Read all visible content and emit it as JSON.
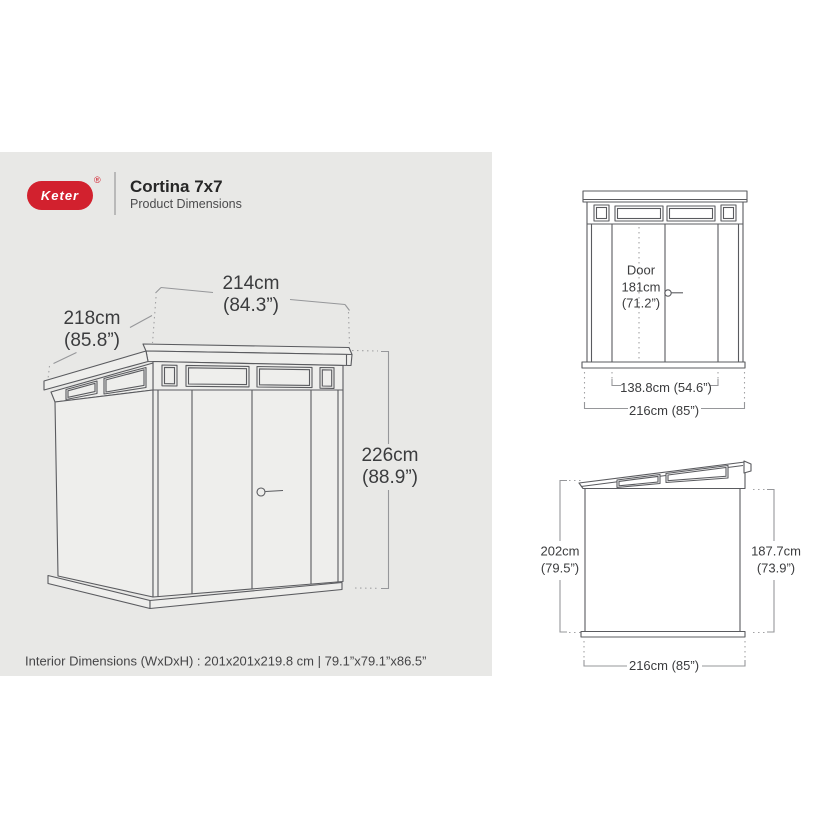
{
  "header": {
    "logo_text": "Keter",
    "registered_mark": "®",
    "title": "Cortina 7x7",
    "subtitle": "Product Dimensions"
  },
  "colors": {
    "brand_red": "#d2212e",
    "panel_gray": "#e8e8e6",
    "line_gray": "#5a5b5f"
  },
  "iso_view": {
    "width_dim": {
      "cm": "214cm",
      "inch": "(84.3”)"
    },
    "depth_dim": {
      "cm": "218cm",
      "inch": "(85.8”)"
    },
    "height_dim": {
      "cm": "226cm",
      "inch": "(88.9”)"
    }
  },
  "front_view": {
    "door_label": {
      "line1": "Door",
      "line2": "181cm",
      "line3": "(71.2”)"
    },
    "door_width": "138.8cm (54.6”)",
    "overall_width": "216cm (85”)"
  },
  "side_view": {
    "left_height": {
      "cm": "202cm",
      "inch": "(79.5”)"
    },
    "right_height": {
      "cm": "187.7cm",
      "inch": "(73.9”)"
    },
    "overall_width": "216cm (85”)"
  },
  "footer": {
    "interior_dimensions": "Interior Dimensions (WxDxH) : 201x201x219.8 cm | 79.1”x79.1”x86.5”"
  }
}
